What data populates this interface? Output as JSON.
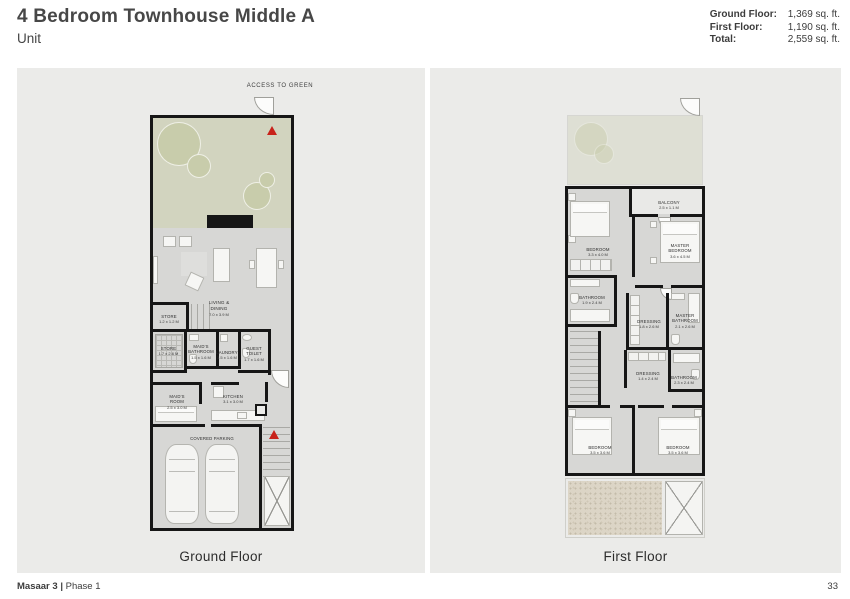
{
  "header": {
    "title": "4 Bedroom Townhouse Middle A",
    "subtitle": "Unit",
    "stats": [
      {
        "label": "Ground Floor:",
        "value": "1,369 sq. ft."
      },
      {
        "label": "First Floor:",
        "value": "1,190 sq. ft."
      },
      {
        "label": "Total:",
        "value": "2,559 sq. ft."
      }
    ]
  },
  "colors": {
    "panel_bg": "#ebebe9",
    "plan_gray": "#d7d7d5",
    "garden_green": "#d2d4bf",
    "wall_black": "#161616",
    "entry_arrow_red": "#c8221a"
  },
  "ground_floor": {
    "caption": "Ground Floor",
    "access_label": "ACCESS TO GREEN",
    "rooms": {
      "living": {
        "name": "LIVING &\nDINING",
        "dim": "7.0 x 3.9 M"
      },
      "store_upper": {
        "name": "STORE",
        "dim": "1.2 x 1.2 M"
      },
      "store": {
        "name": "STORE",
        "dim": "1.7 x 2.6 M"
      },
      "maids_bathroom": {
        "name": "MAID'S\nBATHROOM",
        "dim": "1.5 x 1.6 M"
      },
      "laundry": {
        "name": "LAUNDRY",
        "dim": "1.5 x 1.6 M"
      },
      "guest_toilet": {
        "name": "GUEST\nTOILET",
        "dim": "1.7 x 1.6 M"
      },
      "maids_room": {
        "name": "MAID'S\nROOM",
        "dim": "2.5 x 3.0 M"
      },
      "kitchen": {
        "name": "KITCHEN",
        "dim": "3.1 x 3.0 M"
      },
      "parking": {
        "name": "COVERED PARKING",
        "dim": ""
      }
    }
  },
  "first_floor": {
    "caption": "First Floor",
    "rooms": {
      "balcony": {
        "name": "BALCONY",
        "dim": "2.5 x 1.1 M"
      },
      "bedroom_1": {
        "name": "BEDROOM",
        "dim": "3.3 x 4.0 M"
      },
      "master_bedroom": {
        "name": "MASTER\nBEDROOM",
        "dim": "3.6 x 4.5 M"
      },
      "bathroom_1": {
        "name": "BATHROOM",
        "dim": "1.9 x 2.4 M"
      },
      "dressing_1": {
        "name": "DRESSING",
        "dim": "1.8 x 2.6 M"
      },
      "master_bathroom": {
        "name": "MASTER\nBATHROOM",
        "dim": "2.1 x 2.6 M"
      },
      "dressing_2": {
        "name": "DRESSING",
        "dim": "1.4 x 2.4 M"
      },
      "bathroom_2": {
        "name": "BATHROOM",
        "dim": "2.3 x 2.4 M"
      },
      "bedroom_2": {
        "name": "BEDROOM",
        "dim": "3.5 x 3.6 M"
      },
      "bedroom_3": {
        "name": "BEDROOM",
        "dim": "3.5 x 3.6 M"
      }
    }
  },
  "footer": {
    "project": "Masaar 3",
    "separator": "|",
    "phase": "Phase 1",
    "page_number": "33"
  }
}
